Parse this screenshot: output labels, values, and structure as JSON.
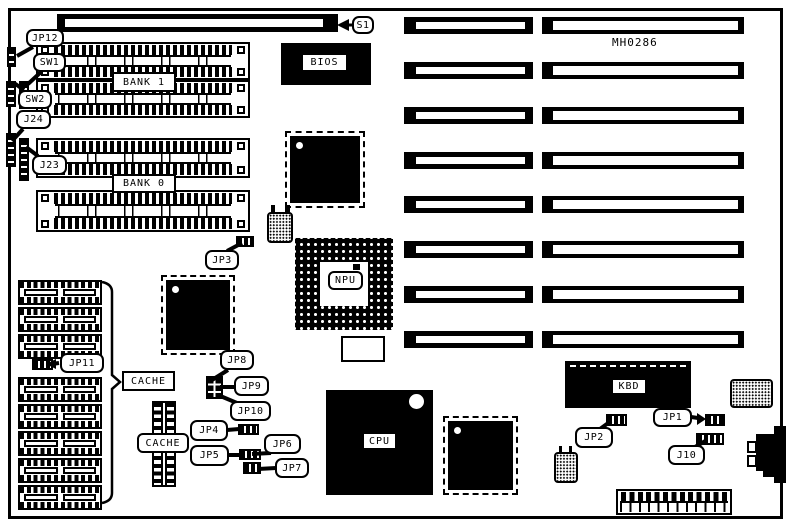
{
  "diagram": {
    "part_number": "MH0286",
    "expansion": {
      "s1_label": "S1",
      "isa_slot_rows": 8
    },
    "memory": {
      "bank1_label": "BANK 1",
      "bank0_label": "BANK 0",
      "simm_sockets": 4
    },
    "cache": {
      "label_main": "CACHE",
      "label_secondary": "CACHE",
      "dip_sockets": 8
    },
    "chips": {
      "bios": "BIOS",
      "npu": "NPU",
      "cpu": "CPU",
      "kbd": "KBD"
    },
    "jumpers": {
      "jp1": "JP1",
      "jp2": "JP2",
      "jp3": "JP3",
      "jp4": "JP4",
      "jp5": "JP5",
      "jp6": "JP6",
      "jp7": "JP7",
      "jp8": "JP8",
      "jp9": "JP9",
      "jp10": "JP10",
      "jp11": "JP11",
      "jp12": "JP12"
    },
    "switches": {
      "sw1": "SW1",
      "sw2": "SW2"
    },
    "connectors": {
      "j10": "J10",
      "j23": "J23",
      "j24": "J24"
    }
  }
}
